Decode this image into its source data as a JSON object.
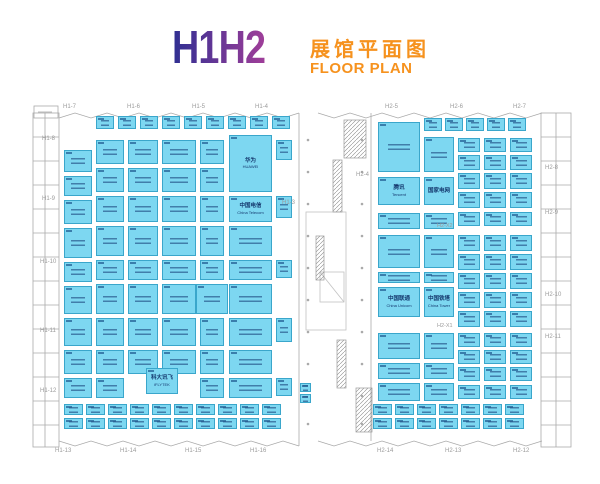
{
  "title": {
    "hall": "H1H2",
    "zh": "展馆平面图",
    "en": "FLOOR PLAN"
  },
  "colors": {
    "grad1": "#2F2F92",
    "grad2": "#A03E99",
    "orange": "#F6921E",
    "booth_fill": "#7DD7F1",
    "booth_border": "#3AA6CB",
    "booth_text": "#14386E",
    "wall": "#A9A9A9",
    "gray": "#9B9B9B"
  },
  "gates": {
    "top": [
      {
        "label": "H1-7",
        "x": 63,
        "y": 104
      },
      {
        "label": "H1-6",
        "x": 127,
        "y": 104
      },
      {
        "label": "H1-5",
        "x": 192,
        "y": 104
      },
      {
        "label": "H1-4",
        "x": 255,
        "y": 104
      },
      {
        "label": "H2-5",
        "x": 385,
        "y": 104
      },
      {
        "label": "H2-6",
        "x": 450,
        "y": 104
      },
      {
        "label": "H2-7",
        "x": 513,
        "y": 104
      }
    ],
    "bottom": [
      {
        "label": "H1-13",
        "x": 55,
        "y": 448
      },
      {
        "label": "H1-14",
        "x": 120,
        "y": 448
      },
      {
        "label": "H1-15",
        "x": 185,
        "y": 448
      },
      {
        "label": "H1-16",
        "x": 250,
        "y": 448
      },
      {
        "label": "H2-14",
        "x": 377,
        "y": 448
      },
      {
        "label": "H2-13",
        "x": 445,
        "y": 448
      },
      {
        "label": "H2-12",
        "x": 513,
        "y": 448
      }
    ],
    "left": [
      {
        "label": "H1-8",
        "x": 42,
        "y": 136
      },
      {
        "label": "H1-9",
        "x": 42,
        "y": 196
      },
      {
        "label": "H1-10",
        "x": 40,
        "y": 259
      },
      {
        "label": "H1-11",
        "x": 40,
        "y": 328
      },
      {
        "label": "H1-12",
        "x": 40,
        "y": 388
      }
    ],
    "right": [
      {
        "label": "H2-8",
        "x": 545,
        "y": 165
      },
      {
        "label": "H2-9",
        "x": 545,
        "y": 210
      },
      {
        "label": "H2-10",
        "x": 545,
        "y": 292
      },
      {
        "label": "H2-11",
        "x": 545,
        "y": 334
      }
    ],
    "corridor": [
      {
        "label": "H1-3",
        "x": 282,
        "y": 200
      },
      {
        "label": "H2-4",
        "x": 356,
        "y": 172
      }
    ]
  },
  "aisle_labels": [
    {
      "text": "H2-X2",
      "x": 437,
      "y": 224
    },
    {
      "text": "H2-X1",
      "x": 437,
      "y": 324
    }
  ],
  "booths": [
    [
      64,
      150,
      28,
      22
    ],
    [
      64,
      176,
      28,
      20
    ],
    [
      64,
      200,
      28,
      24
    ],
    [
      64,
      228,
      28,
      30
    ],
    [
      64,
      262,
      28,
      20
    ],
    [
      64,
      286,
      28,
      28
    ],
    [
      64,
      318,
      28,
      28
    ],
    [
      64,
      350,
      28,
      24
    ],
    [
      64,
      378,
      28,
      20
    ],
    [
      96,
      140,
      28,
      24
    ],
    [
      96,
      168,
      28,
      24
    ],
    [
      96,
      196,
      28,
      26
    ],
    [
      96,
      226,
      28,
      30
    ],
    [
      96,
      260,
      28,
      20
    ],
    [
      96,
      284,
      28,
      30
    ],
    [
      96,
      318,
      28,
      28
    ],
    [
      96,
      350,
      28,
      24
    ],
    [
      96,
      378,
      28,
      20
    ],
    [
      128,
      140,
      30,
      24
    ],
    [
      128,
      168,
      30,
      24
    ],
    [
      128,
      196,
      30,
      26
    ],
    [
      128,
      226,
      30,
      30
    ],
    [
      128,
      260,
      30,
      20
    ],
    [
      128,
      284,
      30,
      30
    ],
    [
      128,
      318,
      30,
      28
    ],
    [
      128,
      350,
      30,
      24
    ],
    [
      162,
      140,
      34,
      24
    ],
    [
      162,
      168,
      34,
      24
    ],
    [
      162,
      196,
      34,
      26
    ],
    [
      162,
      226,
      34,
      30
    ],
    [
      162,
      260,
      34,
      20
    ],
    [
      162,
      284,
      34,
      30
    ],
    [
      162,
      318,
      34,
      28
    ],
    [
      162,
      350,
      34,
      24
    ],
    [
      146,
      368,
      32,
      26,
      "科大讯飞",
      "iFLYTEK"
    ],
    [
      200,
      140,
      24,
      24
    ],
    [
      200,
      168,
      24,
      24
    ],
    [
      200,
      196,
      24,
      26
    ],
    [
      200,
      226,
      24,
      30
    ],
    [
      200,
      260,
      24,
      20
    ],
    [
      200,
      318,
      24,
      28
    ],
    [
      200,
      350,
      24,
      24
    ],
    [
      200,
      378,
      24,
      20
    ],
    [
      196,
      284,
      32,
      30
    ],
    [
      229,
      135,
      43,
      57,
      "华为",
      "HUAWEI"
    ],
    [
      229,
      196,
      43,
      26,
      "中国电信",
      "China Telecom"
    ],
    [
      229,
      226,
      43,
      30
    ],
    [
      229,
      260,
      43,
      20
    ],
    [
      229,
      284,
      43,
      30
    ],
    [
      229,
      318,
      43,
      28
    ],
    [
      229,
      350,
      43,
      24
    ],
    [
      229,
      378,
      43,
      20
    ],
    [
      276,
      140,
      16,
      20
    ],
    [
      276,
      196,
      16,
      22
    ],
    [
      276,
      260,
      16,
      18
    ],
    [
      276,
      318,
      16,
      24
    ],
    [
      276,
      378,
      16,
      18
    ],
    [
      300,
      383,
      11,
      9
    ],
    [
      300,
      394,
      11,
      9
    ],
    [
      378,
      122,
      42,
      50
    ],
    [
      378,
      177,
      42,
      28,
      "腾讯",
      "Tencent"
    ],
    [
      378,
      213,
      42,
      16
    ],
    [
      378,
      235,
      42,
      33
    ],
    [
      378,
      272,
      42,
      11
    ],
    [
      378,
      287,
      42,
      30,
      "中国联通",
      "China Unicom"
    ],
    [
      378,
      333,
      42,
      26
    ],
    [
      378,
      363,
      42,
      16
    ],
    [
      378,
      383,
      42,
      18
    ],
    [
      424,
      137,
      30,
      35
    ],
    [
      424,
      177,
      30,
      28,
      "国家电网",
      ""
    ],
    [
      424,
      213,
      30,
      16
    ],
    [
      424,
      235,
      30,
      33
    ],
    [
      424,
      272,
      30,
      11
    ],
    [
      424,
      287,
      30,
      30,
      "中国铁塔",
      "China Tower"
    ],
    [
      424,
      333,
      30,
      26
    ],
    [
      424,
      363,
      30,
      16
    ],
    [
      424,
      383,
      30,
      18
    ],
    [
      458,
      138,
      22,
      14
    ],
    [
      484,
      138,
      22,
      14
    ],
    [
      510,
      138,
      22,
      14
    ],
    [
      458,
      155,
      22,
      15
    ],
    [
      484,
      155,
      22,
      15
    ],
    [
      510,
      155,
      22,
      15
    ],
    [
      458,
      173,
      22,
      16
    ],
    [
      484,
      173,
      22,
      16
    ],
    [
      510,
      173,
      22,
      16
    ],
    [
      458,
      192,
      22,
      16
    ],
    [
      484,
      192,
      22,
      16
    ],
    [
      510,
      192,
      22,
      16
    ],
    [
      458,
      212,
      22,
      14
    ],
    [
      484,
      212,
      22,
      14
    ],
    [
      510,
      212,
      22,
      14
    ],
    [
      458,
      235,
      22,
      16
    ],
    [
      484,
      235,
      22,
      16
    ],
    [
      510,
      235,
      22,
      16
    ],
    [
      458,
      254,
      22,
      16
    ],
    [
      484,
      254,
      22,
      16
    ],
    [
      510,
      254,
      22,
      16
    ],
    [
      458,
      273,
      22,
      16
    ],
    [
      484,
      273,
      22,
      16
    ],
    [
      510,
      273,
      22,
      16
    ],
    [
      458,
      292,
      22,
      16
    ],
    [
      484,
      292,
      22,
      16
    ],
    [
      510,
      292,
      22,
      16
    ],
    [
      458,
      311,
      22,
      16
    ],
    [
      484,
      311,
      22,
      16
    ],
    [
      510,
      311,
      22,
      16
    ],
    [
      458,
      333,
      22,
      14
    ],
    [
      484,
      333,
      22,
      14
    ],
    [
      510,
      333,
      22,
      14
    ],
    [
      458,
      350,
      22,
      14
    ],
    [
      484,
      350,
      22,
      14
    ],
    [
      510,
      350,
      22,
      14
    ],
    [
      458,
      367,
      22,
      14
    ],
    [
      484,
      367,
      22,
      14
    ],
    [
      510,
      367,
      22,
      14
    ],
    [
      458,
      385,
      22,
      14
    ],
    [
      484,
      385,
      22,
      14
    ],
    [
      510,
      385,
      22,
      14
    ]
  ],
  "strips": [
    {
      "x": 96,
      "y": 116,
      "w": 18,
      "h": 13,
      "count": 9,
      "gap": 4
    },
    {
      "x": 424,
      "y": 118,
      "w": 18,
      "h": 13,
      "count": 5,
      "gap": 3
    },
    {
      "x": 64,
      "y": 404,
      "w": 19,
      "h": 11,
      "count": 10,
      "gap": 3
    },
    {
      "x": 64,
      "y": 418,
      "w": 19,
      "h": 11,
      "count": 10,
      "gap": 3
    },
    {
      "x": 373,
      "y": 404,
      "w": 19,
      "h": 11,
      "count": 7,
      "gap": 3
    },
    {
      "x": 373,
      "y": 418,
      "w": 19,
      "h": 11,
      "count": 7,
      "gap": 3
    }
  ]
}
